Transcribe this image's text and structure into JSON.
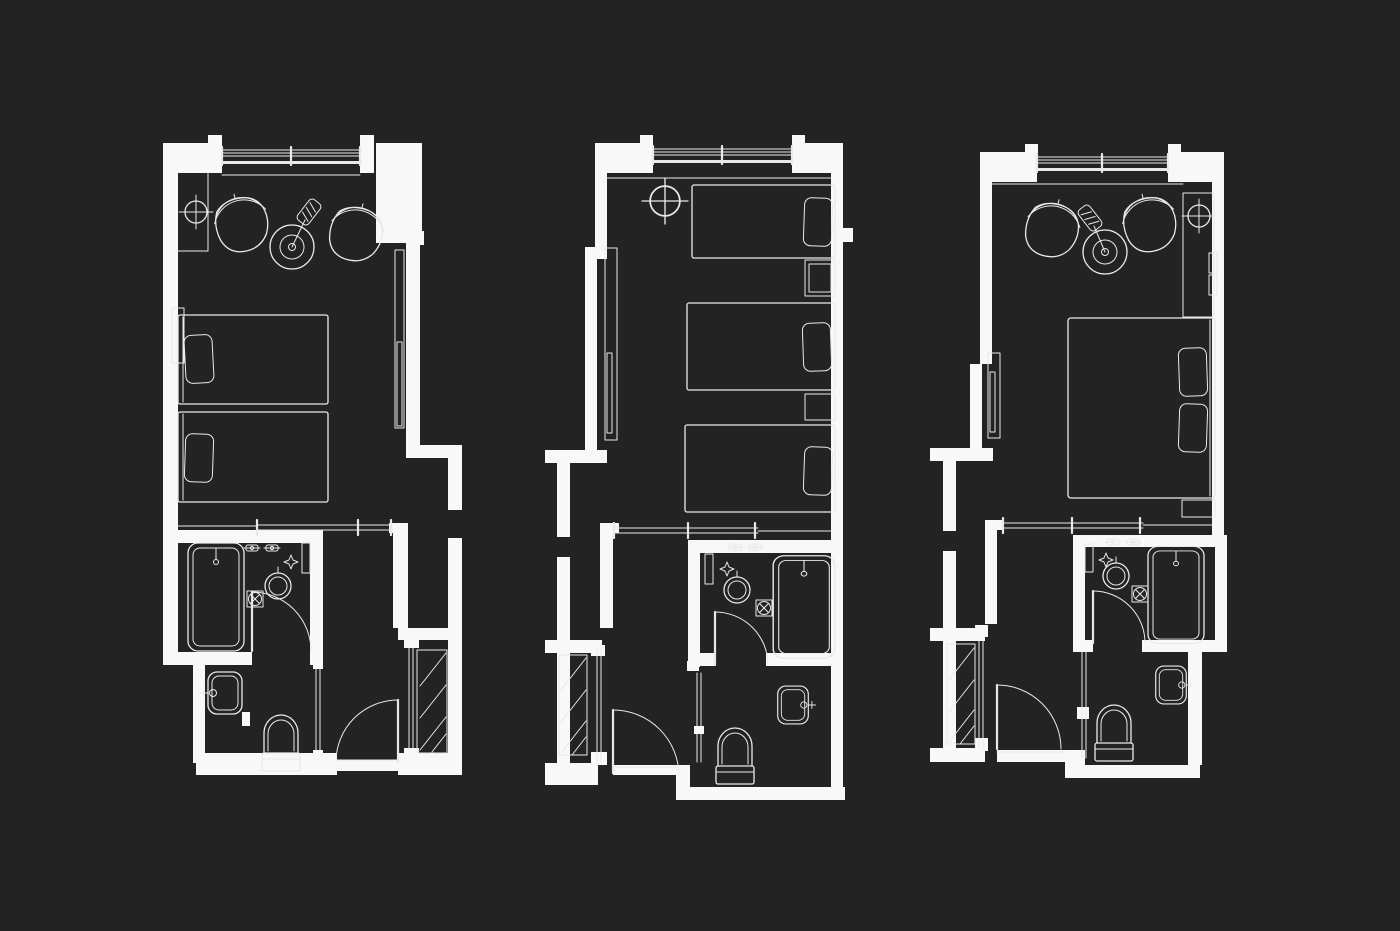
{
  "theme": {
    "bg": "#232323",
    "wall": "#f8f8f8",
    "line": "#e9e9e9"
  },
  "diagram": {
    "type": "architectural-floor-plans",
    "drawing_style": "white-line-on-dark",
    "plans": [
      {
        "id": "twin-room",
        "position": "left",
        "orientation": "entry-bottom-right",
        "zones": [
          "bedroom",
          "bathroom",
          "toilet-room",
          "entry-corridor"
        ],
        "furniture": [
          "window",
          "center-mark",
          "armchair",
          "armchair",
          "floor-lamp",
          "coffee-table",
          "single-bed",
          "single-bed",
          "pillow",
          "pillow",
          "wardrobe-panel",
          "sliding-partition",
          "bathtub",
          "vanity-basin",
          "faucet",
          "faucet",
          "shower-diamond",
          "floor-drain",
          "towel-bar",
          "bathroom-door",
          "washbasin",
          "toilet",
          "pocket-door",
          "entry-door",
          "hatched-closet"
        ]
      },
      {
        "id": "triple-room",
        "position": "center",
        "orientation": "entry-bottom-left",
        "zones": [
          "bedroom",
          "bathroom",
          "toilet-room",
          "entry-corridor"
        ],
        "furniture": [
          "window",
          "center-mark",
          "single-bed",
          "single-bed",
          "single-bed",
          "pillow",
          "pillow",
          "pillow",
          "nightstand",
          "nightstand",
          "console-panel",
          "sliding-partition",
          "bathtub",
          "vanity-basin",
          "faucet",
          "faucet",
          "shower-diamond",
          "floor-drain",
          "towel-bar",
          "bathroom-door",
          "washbasin",
          "toilet",
          "pocket-door",
          "entry-door",
          "hatched-closet"
        ]
      },
      {
        "id": "double-room",
        "position": "right",
        "orientation": "entry-bottom-left",
        "zones": [
          "bedroom",
          "bathroom",
          "toilet-room",
          "entry-corridor"
        ],
        "furniture": [
          "window",
          "center-mark",
          "armchair",
          "armchair",
          "floor-lamp",
          "coffee-table",
          "double-bed",
          "pillow",
          "pillow",
          "nightstand",
          "console-panel",
          "sliding-partition",
          "bathtub",
          "vanity-basin",
          "faucet",
          "faucet",
          "shower-diamond",
          "floor-drain",
          "towel-bar",
          "bathroom-door",
          "washbasin",
          "toilet",
          "pocket-door",
          "entry-door",
          "hatched-closet"
        ]
      }
    ]
  }
}
